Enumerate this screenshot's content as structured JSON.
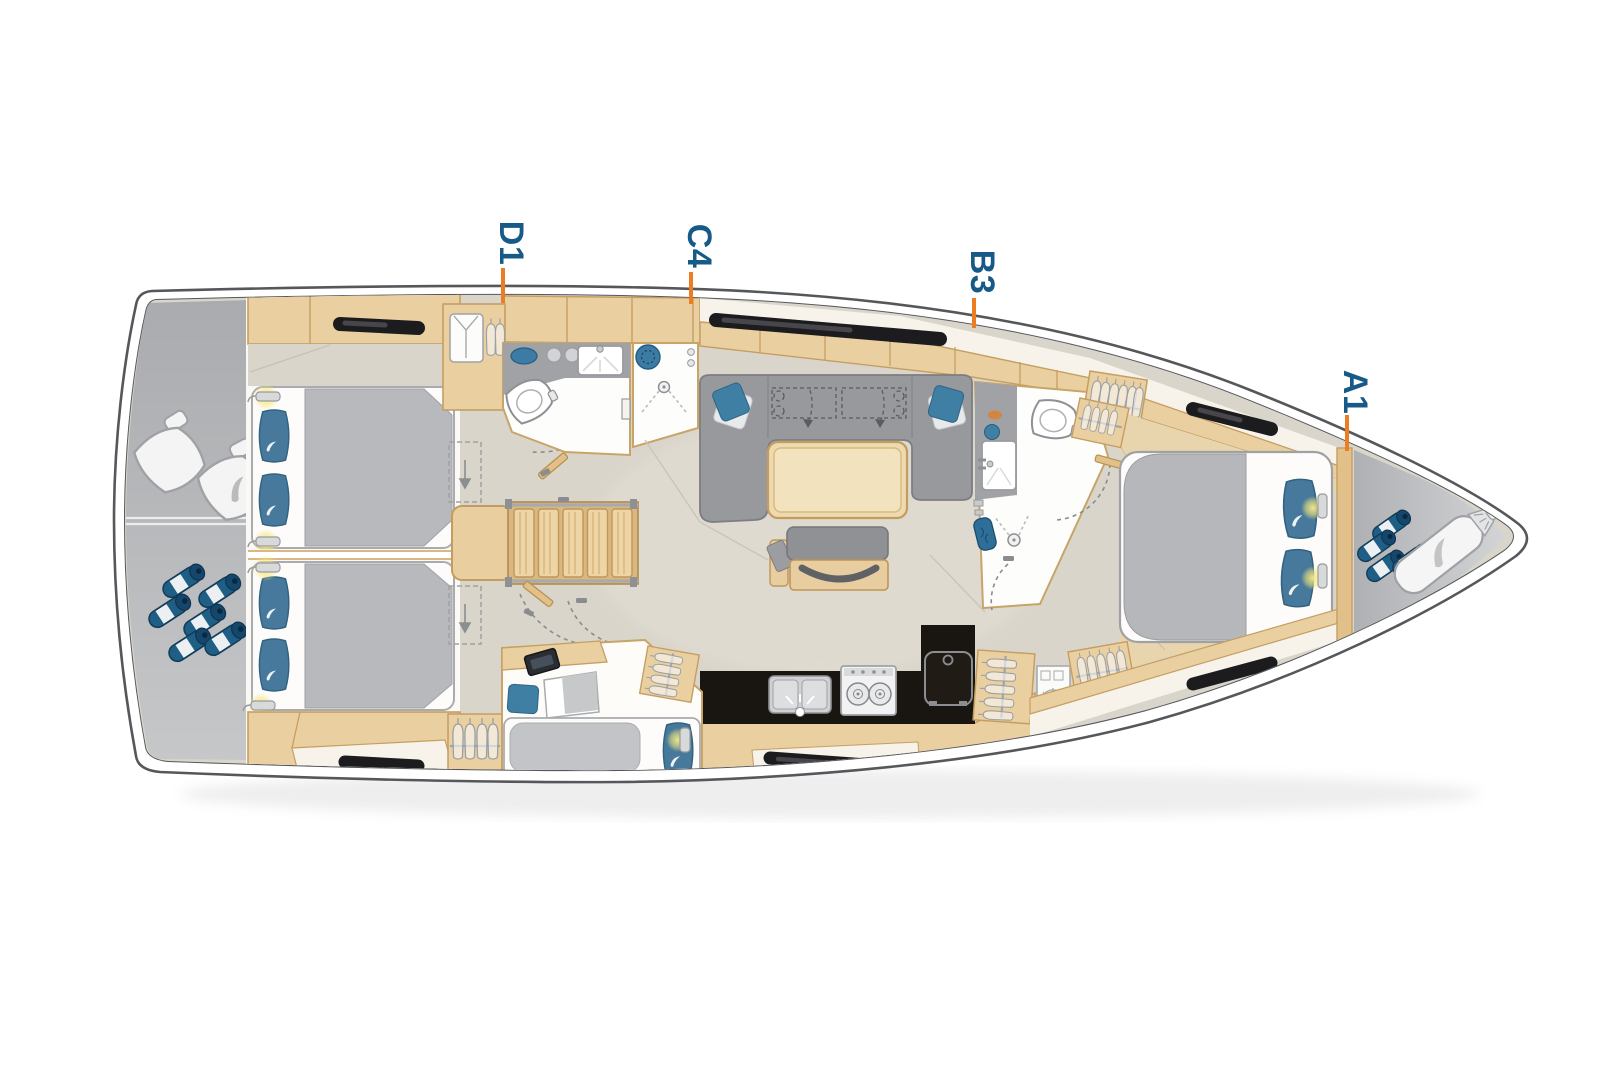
{
  "plan": {
    "title_hint": "sailing-yacht interior deck floor plan, bow pointing right",
    "cabin_labels": [
      {
        "id": "D1",
        "text": "D1"
      },
      {
        "id": "C4",
        "text": "C4"
      },
      {
        "id": "B3",
        "text": "B3"
      },
      {
        "id": "A1",
        "text": "A1"
      }
    ],
    "colors": {
      "label_text": "#175a87",
      "label_tick": "#ed7d23",
      "hull_outline": "#56575b",
      "deck_white": "#ffffff",
      "transom_gray": "#b2b4b7",
      "floor_greige": "#d9d5cb",
      "wood": "#ead0a0",
      "wood_trim": "#c59e62",
      "upholstery_gray": "#97999c",
      "bedding_gray": "#b7b9bc",
      "pillow_blue": "#47799c",
      "galley_counter_black": "#191510",
      "hull_window_black": "#1c1c1e",
      "reading_light_glow": "#f5e678",
      "mattress_white": "#fdfcfa"
    },
    "icons": [
      {
        "name": "helm-seat-icon"
      },
      {
        "name": "fender-icon"
      },
      {
        "name": "sail-bag-icon"
      },
      {
        "name": "swoosh-logo-icon"
      },
      {
        "name": "toilet-icon"
      },
      {
        "name": "sink-icon"
      },
      {
        "name": "shower-icon"
      },
      {
        "name": "stove-icon"
      },
      {
        "name": "fridge-icon"
      },
      {
        "name": "hanger-icon"
      },
      {
        "name": "shirt-icon"
      },
      {
        "name": "tv-icon"
      },
      {
        "name": "reading-light-icon"
      },
      {
        "name": "companionway-stairs-icon"
      },
      {
        "name": "door-swing-icon"
      },
      {
        "name": "hull-window-icon"
      }
    ]
  }
}
